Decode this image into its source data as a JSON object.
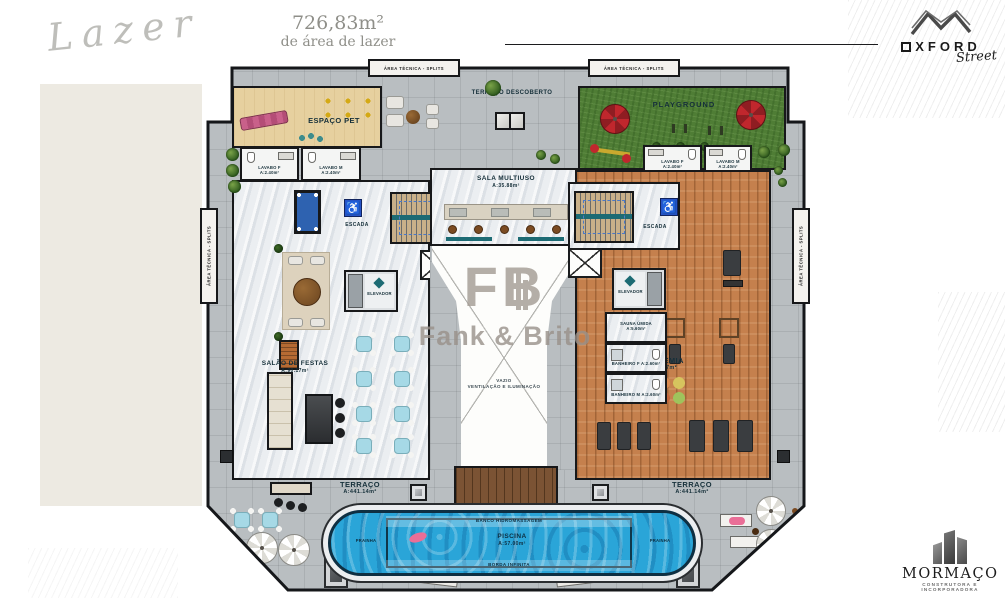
{
  "header": {
    "script_title": "Lazer",
    "area_value": "726,83m²",
    "area_caption": "de área de lazer"
  },
  "brand": {
    "name": "OXFORD",
    "sub": "Street"
  },
  "developer": {
    "name": "MORMAÇO",
    "tagline": "CONSTRUTORA E INCORPORADORA"
  },
  "watermark": {
    "initials": "FB",
    "name": "Fank & Brito"
  },
  "icons": {
    "accessible": "♿"
  },
  "palette": {
    "teal_accent": "#1d6b74",
    "pool_blue": "#2aa5d8",
    "grass_green": "#4f7d35",
    "wood_floor": "#c5804d",
    "pet_tan": "#e6d09f",
    "terrace_gray": "#b9bec1"
  },
  "plan": {
    "area_tecnica": "ÁREA TÉCNICA - SPLITS",
    "rooms": {
      "espaco_pet": {
        "label": "ESPAÇO PET"
      },
      "terraco_descoberto": {
        "label": "TERRAÇO DESCOBERTO"
      },
      "playground": {
        "label": "PLAYGROUND"
      },
      "sala_multiuso": {
        "label": "SALA MULTIUSO",
        "area": "A:35.88m²"
      },
      "salao_de_festas": {
        "label": "SALÃO DE FESTAS",
        "area": "A:90.17m²"
      },
      "academia": {
        "label": "ACADEMIA",
        "area": "A:81.17m²"
      },
      "vazio": {
        "line1": "VAZIO",
        "line2": "VENTILAÇÃO E ILUMINAÇÃO"
      },
      "escada": {
        "label": "ESCADA"
      },
      "elevador": {
        "label": "ELEVADOR"
      },
      "terraco": {
        "label": "TERRAÇO",
        "area": "A:441.14m²"
      },
      "piscina": {
        "label": "PISCINA",
        "area": "A:57.00m²"
      },
      "prainha": {
        "label": "PRAINHA"
      },
      "banco_hidro": {
        "label": "BANCO HIDROMASSAGEM"
      },
      "borda_infinita": {
        "label": "BORDA INFINITA"
      },
      "lavabo_f": {
        "label": "LAVABO F",
        "area": "A:2.40m²"
      },
      "lavabo_m": {
        "label": "LAVABO M",
        "area": "A:2.40m²"
      },
      "sauna": {
        "label": "SAUNA ÚMIDA",
        "area": "A:5.60m²"
      },
      "banheiro_f": {
        "label": "BANHEIRO F",
        "area": "A:2.60m²"
      },
      "banheiro_m": {
        "label": "BANHEIRO M",
        "area": "A:2.60m²"
      }
    }
  }
}
